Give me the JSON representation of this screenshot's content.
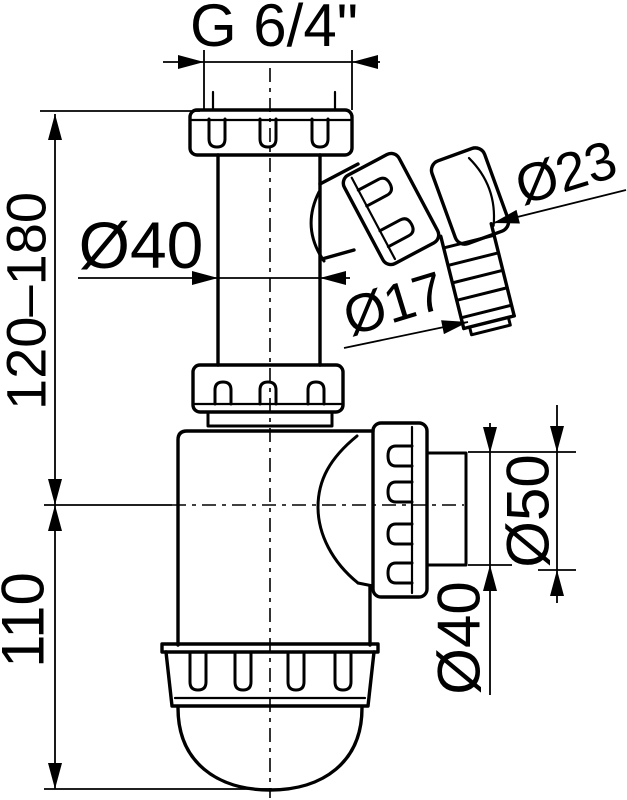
{
  "colors": {
    "background": "#ffffff",
    "line": "#000000"
  },
  "labels": {
    "top_thread": "G 6/4\"",
    "inlet_diameter": "Ø40",
    "hose_step_large": "Ø23",
    "hose_step_small": "Ø17",
    "outlet_socket": "Ø50",
    "outlet_pipe": "Ø40",
    "height_adjustable": "120–180",
    "height_body": "110"
  }
}
